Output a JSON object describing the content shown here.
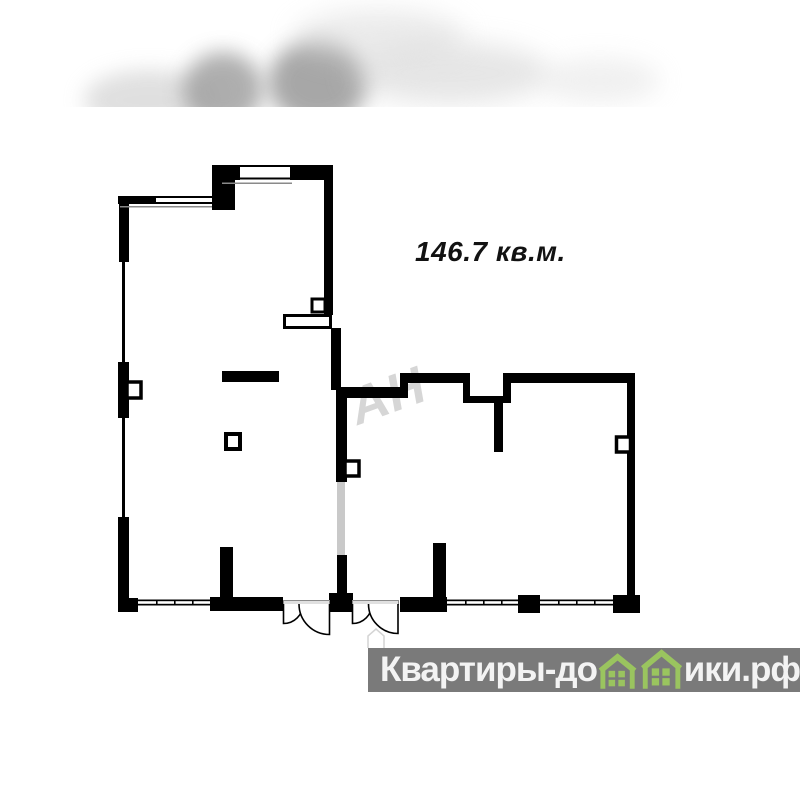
{
  "floor_plan": {
    "area_label": "146.7 кв.м.",
    "watermark_text": "АН",
    "wall_color": "#000000",
    "removed_wall_color": "#c9c9c9",
    "window_line_color": "#000000",
    "sill_line_color": "#8a8a8a",
    "threshold_color": "#e0e0e0"
  },
  "footer_logo": {
    "text_before_houses": "Квартиры-до",
    "text_after_houses": "ики.рф",
    "band_color": "#7a7a7a",
    "text_color": "#f3f3f3",
    "house_icon_color": "#9ac45f"
  }
}
